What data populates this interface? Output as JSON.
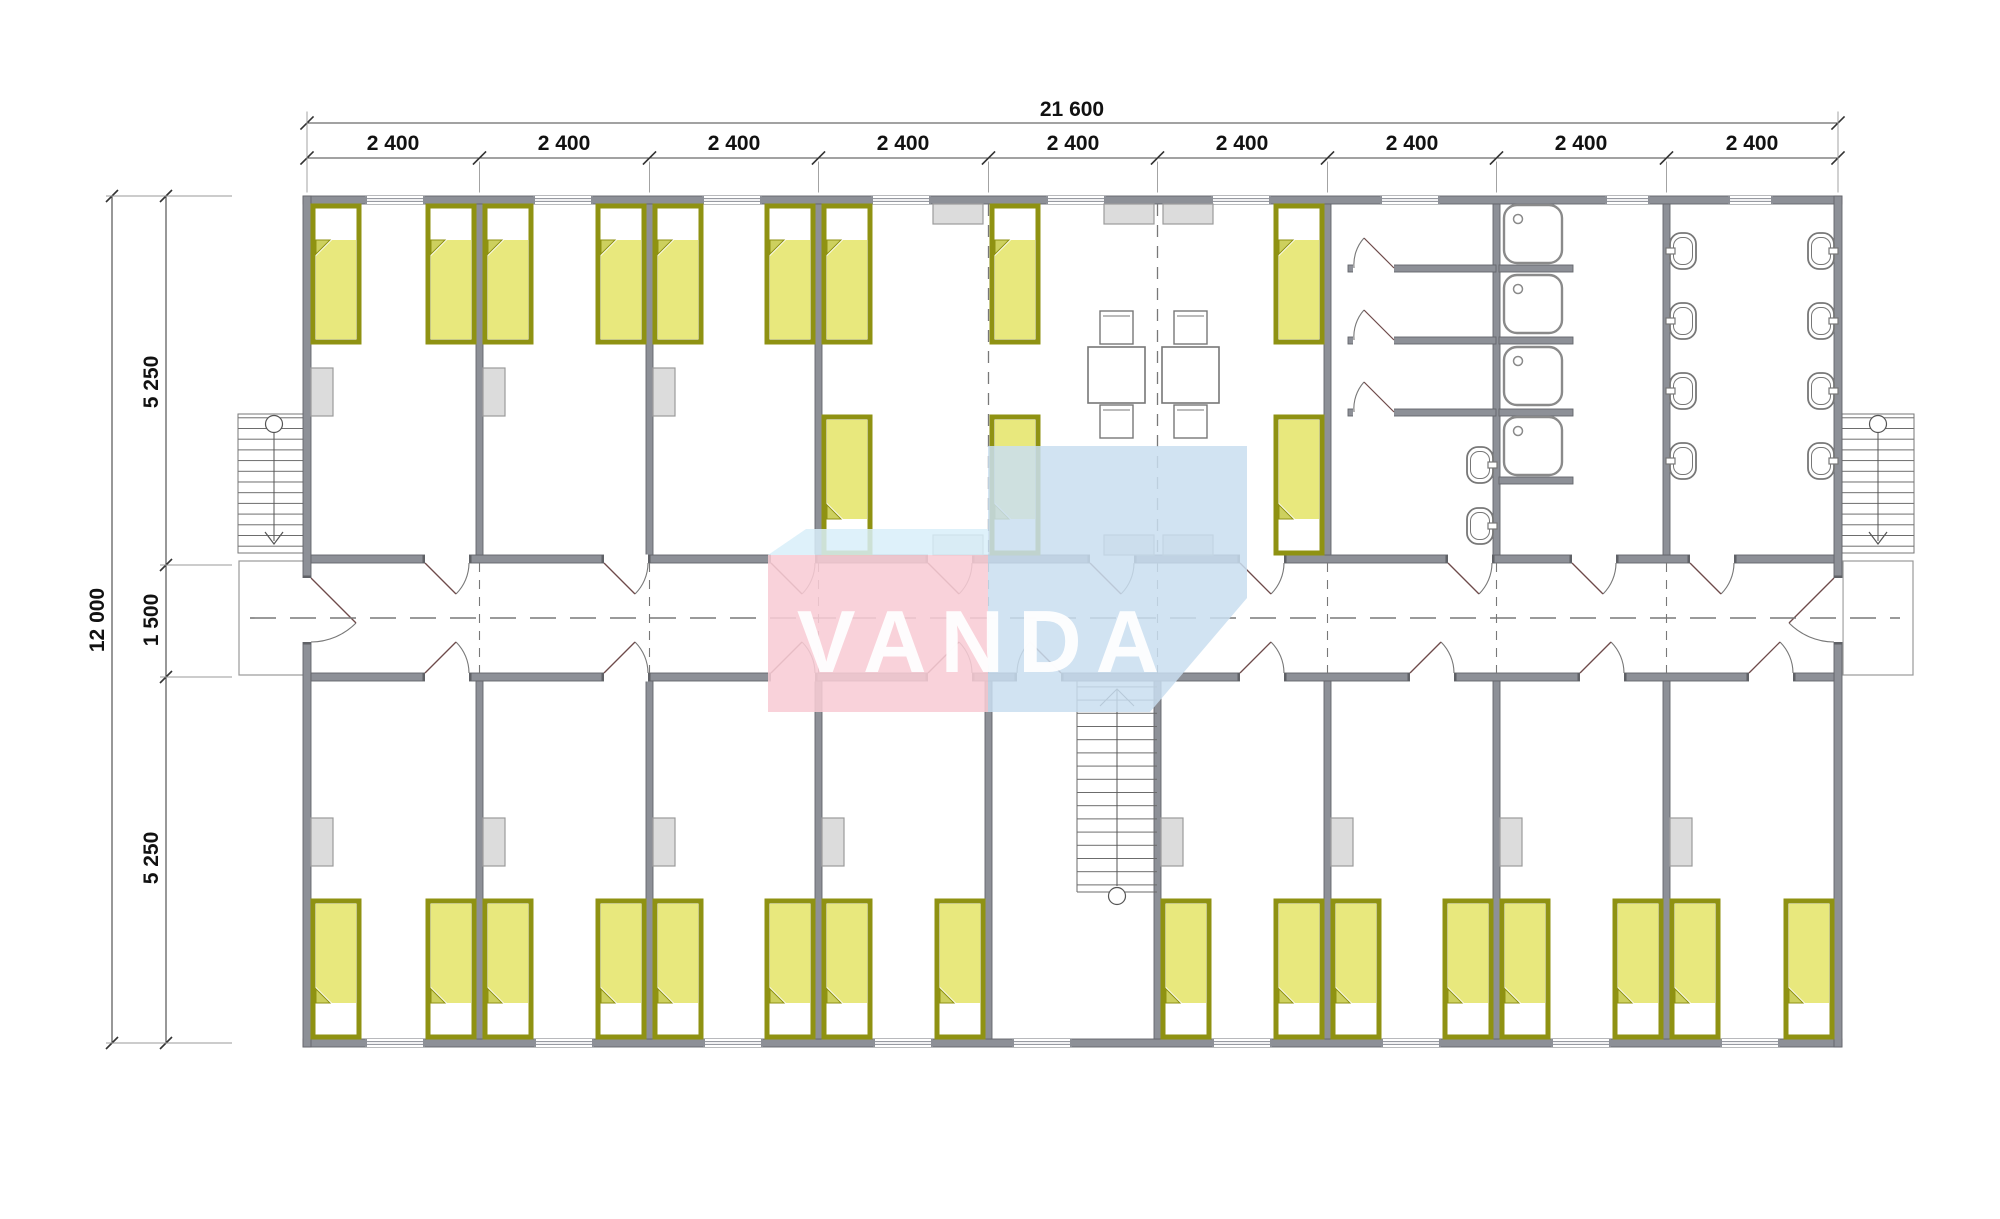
{
  "plan": {
    "watermark": {
      "text": "VANDA",
      "pink": "#f8ccd5",
      "blue": "#c9def0",
      "blue_light": "#d8eef9",
      "text_color": "#ffffff"
    },
    "dimensions": {
      "total_width": "21 600",
      "modules": [
        "2 400",
        "2 400",
        "2 400",
        "2 400",
        "2 400",
        "2 400",
        "2 400",
        "2 400",
        "2 400"
      ],
      "total_height": "12 000",
      "height_segments": [
        "5 250",
        "1 500",
        "5 250"
      ]
    },
    "colors": {
      "wall": "#8d9097",
      "wall_dark": "#5f6166",
      "bed_border": "#8f9212",
      "bed_fill": "#e8e87d",
      "bed_flap": "#cdd05e",
      "cabinet": "#dcdcdc",
      "thin_line": "#777777",
      "dim_line": "#333333"
    }
  }
}
